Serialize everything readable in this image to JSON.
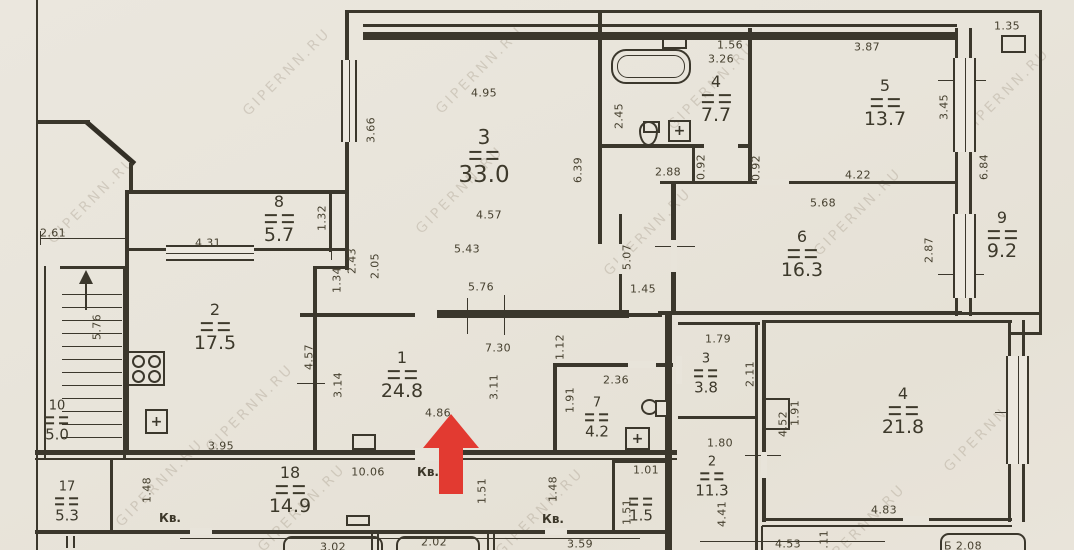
{
  "colors": {
    "paper": "#e8e4da",
    "line": "#3b372c",
    "arrow": "#e23a31",
    "watermark_color": "#8f8270"
  },
  "watermark": {
    "text": "GIPERNN.RU",
    "color": "rgba(143,130,112,0.5)"
  },
  "rooms": [
    {
      "name": "room-3-living",
      "number": "3",
      "area": "33.0"
    },
    {
      "name": "room-4-bathroom",
      "number": "4",
      "area": "7.7"
    },
    {
      "name": "room-5",
      "number": "5",
      "area": "13.7"
    },
    {
      "name": "room-6",
      "number": "6",
      "area": "16.3"
    },
    {
      "name": "room-9",
      "number": "9",
      "area": "9.2"
    },
    {
      "name": "room-8",
      "number": "8",
      "area": "5.7"
    },
    {
      "name": "room-2-kitchen",
      "number": "2",
      "area": "17.5"
    },
    {
      "name": "room-1-hall",
      "number": "1",
      "area": "24.8"
    },
    {
      "name": "room-7-wc",
      "number": "7",
      "area": "4.2"
    },
    {
      "name": "room-3-right",
      "number": "3",
      "area": "3.8"
    },
    {
      "name": "room-2-right",
      "number": "2",
      "area": "11.3"
    },
    {
      "name": "room-4-right",
      "number": "4",
      "area": "21.8"
    },
    {
      "name": "room-10",
      "number": "10",
      "area": "5.0"
    },
    {
      "name": "room-17",
      "number": "17",
      "area": "5.3"
    },
    {
      "name": "room-18",
      "number": "18",
      "area": "14.9"
    },
    {
      "name": "room-1-5",
      "number": "",
      "area": "1.5"
    }
  ],
  "dimensions": [
    [
      "4.95",
      484,
      93,
      0
    ],
    [
      "3.66",
      371,
      130,
      1
    ],
    [
      "6.39",
      578,
      170,
      1
    ],
    [
      "4.57",
      489,
      215,
      0
    ],
    [
      "5.43",
      467,
      249,
      0
    ],
    [
      "2.43",
      352,
      261,
      1
    ],
    [
      "2.05",
      375,
      266,
      1
    ],
    [
      "5.76",
      481,
      287,
      0
    ],
    [
      "1.34",
      337,
      280,
      1
    ],
    [
      "2.61",
      53,
      233,
      0
    ],
    [
      "4.31",
      208,
      243,
      0
    ],
    [
      "1.32",
      322,
      218,
      1
    ],
    [
      "5.76",
      97,
      327,
      1
    ],
    [
      "1.56",
      730,
      45,
      0
    ],
    [
      "3.26",
      721,
      59,
      0
    ],
    [
      "2.45",
      619,
      116,
      1
    ],
    [
      "3.87",
      867,
      47,
      0
    ],
    [
      "1.35",
      1007,
      26,
      0
    ],
    [
      "3.45",
      944,
      107,
      1
    ],
    [
      "6.84",
      984,
      167,
      1
    ],
    [
      "4.22",
      858,
      175,
      0
    ],
    [
      "2.88",
      668,
      172,
      0
    ],
    [
      "0.92",
      701,
      167,
      1
    ],
    [
      "0.92",
      756,
      168,
      1
    ],
    [
      "5.68",
      823,
      203,
      0
    ],
    [
      "1.45",
      643,
      289,
      0
    ],
    [
      "5.07",
      627,
      257,
      1
    ],
    [
      "2.87",
      929,
      250,
      1
    ],
    [
      "4.57",
      309,
      357,
      1
    ],
    [
      "3.14",
      338,
      385,
      1
    ],
    [
      "7.30",
      498,
      348,
      0
    ],
    [
      "1.12",
      560,
      347,
      1
    ],
    [
      "3.11",
      494,
      387,
      1
    ],
    [
      "4.86",
      438,
      413,
      0
    ],
    [
      "2.36",
      616,
      380,
      0
    ],
    [
      "1.91",
      570,
      400,
      1
    ],
    [
      "1.91",
      795,
      413,
      1
    ],
    [
      "1.79",
      718,
      339,
      0
    ],
    [
      "2.11",
      750,
      374,
      1
    ],
    [
      "1.80",
      720,
      443,
      0
    ],
    [
      "4.41",
      722,
      514,
      1
    ],
    [
      "4.52",
      783,
      424,
      1
    ],
    [
      "4.83",
      884,
      510,
      0
    ],
    [
      "4.53",
      788,
      544,
      0
    ],
    [
      "1.11",
      824,
      543,
      1
    ],
    [
      "Б 2.08",
      963,
      546,
      0
    ],
    [
      "3.59",
      580,
      544,
      0
    ],
    [
      "1.01",
      646,
      470,
      0
    ],
    [
      "1.51",
      627,
      512,
      1
    ],
    [
      "10.06",
      368,
      472,
      0
    ],
    [
      "1.48",
      147,
      490,
      1
    ],
    [
      "1.51",
      482,
      491,
      1
    ],
    [
      "1.48",
      553,
      489,
      1
    ],
    [
      "3.95",
      221,
      446,
      0
    ],
    [
      "3.02",
      333,
      547,
      0
    ],
    [
      "2.02",
      434,
      542,
      0
    ]
  ],
  "texts": [
    [
      "Кв.",
      428,
      472
    ],
    [
      "Кв.",
      170,
      518
    ],
    [
      "Кв.",
      553,
      519
    ]
  ],
  "icons": [
    {
      "type": "stove",
      "x": 127,
      "y": 351,
      "w": 38,
      "h": 35
    },
    {
      "type": "sink",
      "x": 145,
      "y": 409,
      "w": 23,
      "h": 25,
      "glyph": "+"
    },
    {
      "type": "tub",
      "x": 611,
      "y": 49,
      "w": 80,
      "h": 35
    },
    {
      "type": "toilet-v",
      "x": 639,
      "y": 121,
      "w": 19,
      "h": 25
    },
    {
      "type": "sink",
      "x": 668,
      "y": 120,
      "w": 23,
      "h": 22,
      "glyph": "+"
    },
    {
      "type": "toilet-h",
      "x": 641,
      "y": 399,
      "w": 17,
      "h": 16
    },
    {
      "type": "sink",
      "x": 625,
      "y": 427,
      "w": 25,
      "h": 23,
      "glyph": "+"
    },
    {
      "type": "vent-box",
      "x": 662,
      "y": 34,
      "w": 25,
      "h": 15
    },
    {
      "type": "box",
      "x": 1001,
      "y": 35,
      "w": 25,
      "h": 18
    },
    {
      "type": "box",
      "x": 352,
      "y": 434,
      "w": 24,
      "h": 16
    },
    {
      "type": "niche-box",
      "x": 764,
      "y": 398,
      "w": 26,
      "h": 32
    },
    {
      "type": "box",
      "x": 346,
      "y": 515,
      "w": 24,
      "h": 11
    }
  ]
}
